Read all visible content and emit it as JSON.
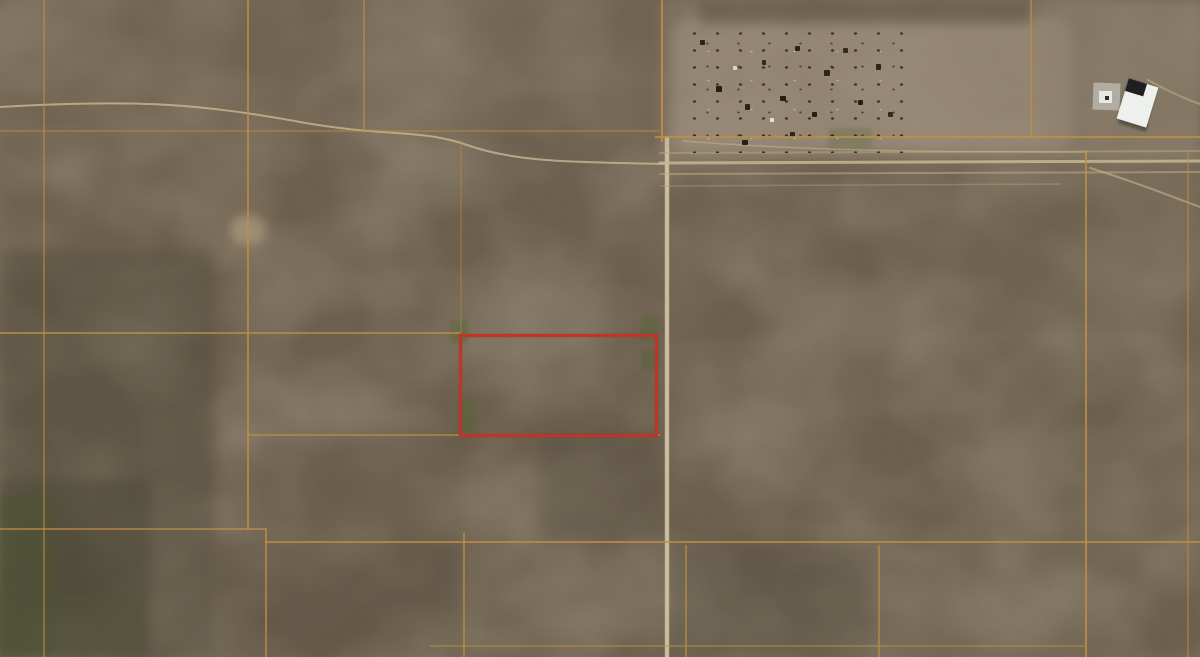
{
  "view": {
    "width": 1200,
    "height": 657,
    "imagery_type": "satellite-aerial-desert-parcels"
  },
  "colors": {
    "terrain_base": "#6c5f4e",
    "terrain_dark_speckle": "#33291d",
    "terrain_light_speckle": "#c7b28c",
    "parcel_line_orange": "#c18f44",
    "dirt_road_tan": "#c9b593",
    "highlight_red": "#c13529",
    "cleared_ground": "#978872",
    "vegetation_dark": "#4d5434",
    "building_white": "#eef0ee",
    "building_dark_roof": "#1f1f1f",
    "concrete_pad_gray": "#b7b2a8"
  },
  "map": {
    "highlight_parcel": {
      "x": 459,
      "y": 334,
      "w": 199,
      "h": 103
    },
    "grid_lines": {
      "vertical": [
        {
          "x": 43,
          "y1": 0,
          "y2": 657,
          "o": 0.5
        },
        {
          "x": 247,
          "y1": 0,
          "y2": 530,
          "o": 0.75
        },
        {
          "x": 265,
          "y1": 528,
          "y2": 657,
          "o": 0.7
        },
        {
          "x": 363,
          "y1": 0,
          "y2": 133,
          "o": 0.55
        },
        {
          "x": 460,
          "y1": 140,
          "y2": 334,
          "o": 0.3
        },
        {
          "x": 463,
          "y1": 533,
          "y2": 657,
          "o": 0.65
        },
        {
          "x": 661,
          "y1": 0,
          "y2": 142,
          "o": 0.85
        },
        {
          "x": 1030,
          "y1": 0,
          "y2": 137,
          "o": 0.6
        },
        {
          "x": 1085,
          "y1": 150,
          "y2": 657,
          "o": 0.8
        },
        {
          "x": 1187,
          "y1": 152,
          "y2": 657,
          "o": 0.45
        },
        {
          "x": 685,
          "y1": 545,
          "y2": 657,
          "o": 0.6
        },
        {
          "x": 878,
          "y1": 545,
          "y2": 657,
          "o": 0.6
        }
      ],
      "horizontal": [
        {
          "y": 130,
          "x1": 0,
          "x2": 660,
          "o": 0.4
        },
        {
          "y": 136,
          "x1": 655,
          "x2": 1200,
          "o": 0.8
        },
        {
          "y": 332,
          "x1": 0,
          "x2": 460,
          "o": 0.7
        },
        {
          "y": 434,
          "x1": 247,
          "x2": 660,
          "o": 0.6
        },
        {
          "y": 528,
          "x1": 0,
          "x2": 266,
          "o": 0.65
        },
        {
          "y": 541,
          "x1": 265,
          "x2": 1200,
          "o": 0.75
        },
        {
          "y": 645,
          "x1": 430,
          "x2": 1085,
          "o": 0.45
        }
      ]
    },
    "roads": [
      {
        "d": "M0,107 C140,99 200,104 300,122 C390,138 420,128 470,146 C520,163 580,162 666,164",
        "w": 2,
        "stroke": "#c6b28e",
        "o": 0.85
      },
      {
        "d": "M667,138 L667,657",
        "w": 4.5,
        "stroke": "#cdbc9e",
        "o": 0.9
      },
      {
        "d": "M667,150 L667,657",
        "w": 1.5,
        "stroke": "#dccfb2",
        "o": 0.55
      },
      {
        "d": "M660,153 L1200,151",
        "w": 2,
        "stroke": "#b9a37c",
        "o": 0.55
      },
      {
        "d": "M660,163 L1200,161",
        "w": 3,
        "stroke": "#c9b593",
        "o": 0.85
      },
      {
        "d": "M660,174 L1200,172",
        "w": 2,
        "stroke": "#bfab87",
        "o": 0.55
      },
      {
        "d": "M660,186 L1060,184",
        "w": 1.5,
        "stroke": "#b6a07a",
        "o": 0.45
      },
      {
        "d": "M1090,168 C1130,180 1170,196 1200,207",
        "w": 2,
        "stroke": "#c2ae8a",
        "o": 0.65
      },
      {
        "d": "M1148,80 C1170,92 1188,100 1200,104",
        "w": 2,
        "stroke": "#c2ae8a",
        "o": 0.55
      },
      {
        "d": "M683,141 C800,150 900,152 1085,152",
        "w": 1.5,
        "stroke": "#c9b593",
        "o": 0.5
      }
    ],
    "tints": [
      {
        "x": 0,
        "y": 0,
        "w": 660,
        "h": 135,
        "c": "rgba(139,123,99,0.18)",
        "b": 4
      },
      {
        "x": 660,
        "y": 0,
        "w": 540,
        "h": 160,
        "c": "rgba(146,133,113,0.45)",
        "b": 5
      },
      {
        "x": 672,
        "y": 18,
        "w": 400,
        "h": 134,
        "c": "rgba(165,152,132,0.50)",
        "b": 6,
        "r": 18
      },
      {
        "x": 1048,
        "y": 0,
        "w": 152,
        "h": 160,
        "c": "rgba(138,125,107,0.35)",
        "b": 4
      },
      {
        "x": 700,
        "y": 0,
        "w": 330,
        "h": 24,
        "c": "rgba(84,72,58,0.40)",
        "b": 5
      },
      {
        "x": 0,
        "y": 250,
        "w": 215,
        "h": 407,
        "c": "rgba(66,64,48,0.30)",
        "b": 6
      },
      {
        "x": 0,
        "y": 480,
        "w": 150,
        "h": 177,
        "c": "rgba(60,60,42,0.35)",
        "b": 6
      },
      {
        "x": 215,
        "y": 540,
        "w": 250,
        "h": 117,
        "c": "rgba(72,69,52,0.22)",
        "b": 6
      },
      {
        "x": 540,
        "y": 430,
        "w": 125,
        "h": 110,
        "c": "rgba(70,66,50,0.25)",
        "b": 8
      },
      {
        "x": 255,
        "y": 435,
        "w": 210,
        "h": 105,
        "c": "rgba(74,68,52,0.18)",
        "b": 8
      },
      {
        "x": 672,
        "y": 545,
        "w": 200,
        "h": 112,
        "c": "rgba(60,62,46,0.20)",
        "b": 8
      },
      {
        "x": 880,
        "y": 180,
        "w": 320,
        "h": 130,
        "c": "rgba(136,120,96,0.15)",
        "b": 10
      },
      {
        "x": 180,
        "y": 185,
        "w": 100,
        "h": 80,
        "c": "rgba(150,135,108,0.18)",
        "b": 10,
        "r": 40
      },
      {
        "x": 230,
        "y": 215,
        "w": 36,
        "h": 30,
        "c": "rgba(190,173,142,0.50)",
        "b": 5,
        "r": 14
      },
      {
        "x": 360,
        "y": 270,
        "w": 60,
        "h": 40,
        "c": "rgba(160,145,118,0.25)",
        "b": 8,
        "r": 20
      },
      {
        "x": 940,
        "y": 440,
        "w": 130,
        "h": 60,
        "c": "rgba(130,118,96,0.20)",
        "b": 8,
        "r": 20
      }
    ],
    "vegetation_patches": [
      {
        "x": 450,
        "y": 320,
        "w": 18,
        "h": 24,
        "c": "#5c6a3f",
        "o": 0.55
      },
      {
        "x": 460,
        "y": 398,
        "w": 16,
        "h": 34,
        "c": "#566538",
        "o": 0.5
      },
      {
        "x": 642,
        "y": 316,
        "w": 16,
        "h": 26,
        "c": "#5a683c",
        "o": 0.5
      },
      {
        "x": 641,
        "y": 350,
        "w": 18,
        "h": 20,
        "c": "#525f36",
        "o": 0.45
      },
      {
        "x": 0,
        "y": 495,
        "w": 55,
        "h": 162,
        "c": "#4d5434",
        "o": 0.5
      },
      {
        "x": 55,
        "y": 595,
        "w": 90,
        "h": 62,
        "c": "#515636",
        "o": 0.35
      },
      {
        "x": 828,
        "y": 128,
        "w": 44,
        "h": 22,
        "c": "#66704a",
        "o": 0.35
      }
    ],
    "debris_field": {
      "x": 683,
      "y": 25,
      "w": 225,
      "h": 128
    },
    "debris_objects": [
      {
        "x": 700,
        "y": 40,
        "w": 5,
        "h": 5,
        "c": "#2b241b"
      },
      {
        "x": 716,
        "y": 86,
        "w": 6,
        "h": 6,
        "c": "#241e16"
      },
      {
        "x": 745,
        "y": 104,
        "w": 5,
        "h": 6,
        "c": "#2b241b"
      },
      {
        "x": 762,
        "y": 60,
        "w": 4,
        "h": 5,
        "c": "#332a1f"
      },
      {
        "x": 780,
        "y": 96,
        "w": 6,
        "h": 5,
        "c": "#241e16"
      },
      {
        "x": 795,
        "y": 46,
        "w": 5,
        "h": 5,
        "c": "#2b241b"
      },
      {
        "x": 812,
        "y": 112,
        "w": 5,
        "h": 5,
        "c": "#241e16"
      },
      {
        "x": 824,
        "y": 70,
        "w": 6,
        "h": 6,
        "c": "#2b241b"
      },
      {
        "x": 843,
        "y": 48,
        "w": 5,
        "h": 5,
        "c": "#332a1f"
      },
      {
        "x": 858,
        "y": 100,
        "w": 5,
        "h": 5,
        "c": "#241e16"
      },
      {
        "x": 876,
        "y": 64,
        "w": 5,
        "h": 6,
        "c": "#2b241b"
      },
      {
        "x": 888,
        "y": 112,
        "w": 5,
        "h": 5,
        "c": "#332a1f"
      },
      {
        "x": 742,
        "y": 140,
        "w": 6,
        "h": 5,
        "c": "#241e16"
      },
      {
        "x": 790,
        "y": 132,
        "w": 5,
        "h": 5,
        "c": "#2b241b"
      },
      {
        "x": 770,
        "y": 118,
        "w": 4,
        "h": 4,
        "c": "#e8e2d6"
      },
      {
        "x": 733,
        "y": 66,
        "w": 4,
        "h": 4,
        "c": "#ded7c8"
      }
    ],
    "structures": {
      "concrete_pad": {
        "x": 1093,
        "y": 83,
        "w": 27,
        "h": 27,
        "rot": 2
      },
      "pad_inner_white": {
        "x": 1099,
        "y": 91,
        "w": 13,
        "h": 12
      },
      "pad_dark_dot": {
        "x": 1105,
        "y": 96,
        "w": 4,
        "h": 4
      },
      "white_building": {
        "x": 1122,
        "y": 82,
        "w": 31,
        "h": 42,
        "rot": 17
      },
      "building_shadow": {
        "x": 1118,
        "y": 120,
        "w": 30,
        "h": 8,
        "rot": 17
      }
    }
  }
}
